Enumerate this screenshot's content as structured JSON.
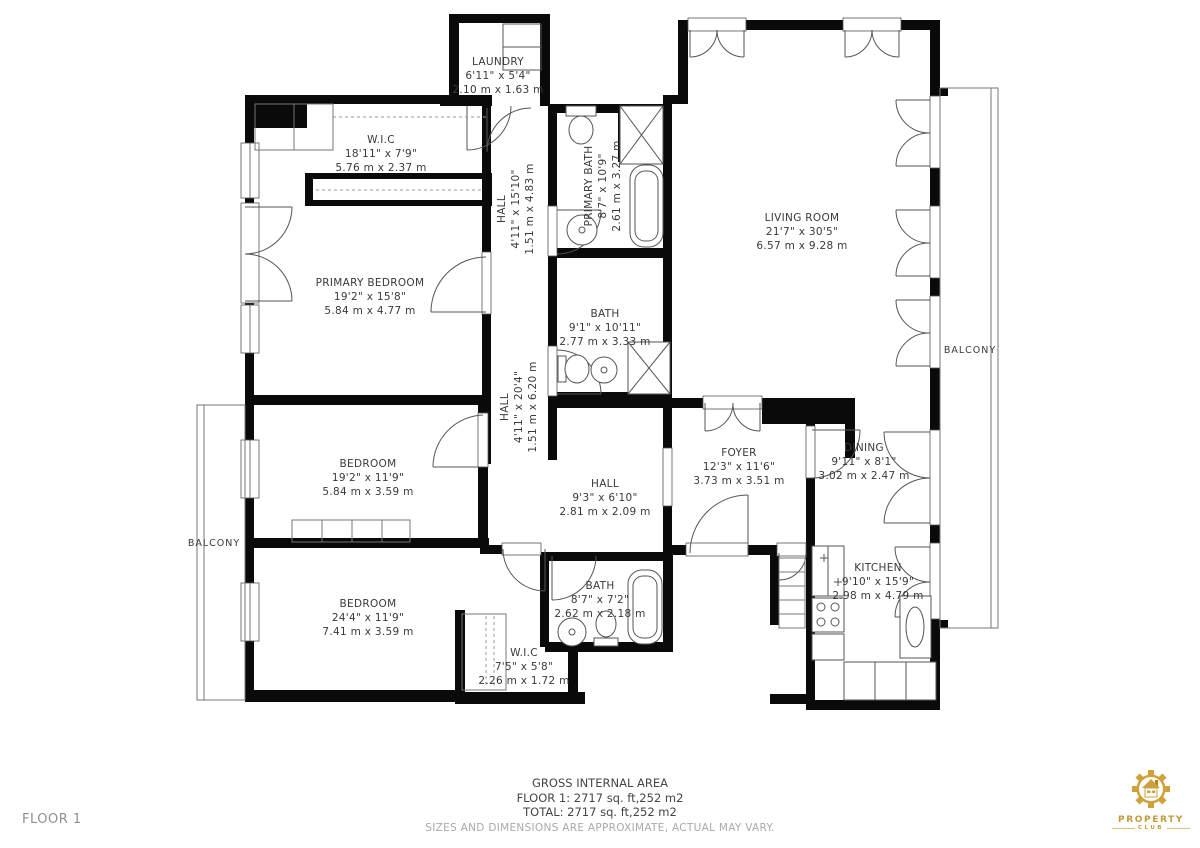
{
  "floor_tag": "FLOOR 1",
  "summary": {
    "title": "GROSS INTERNAL AREA",
    "floor_line": "FLOOR 1: 2717 sq. ft,252 m2",
    "total_line": "TOTAL: 2717 sq. ft,252 m2",
    "disclaimer": "SIZES AND DIMENSIONS ARE APPROXIMATE, ACTUAL MAY VARY."
  },
  "logo": {
    "name": "PROPERTY",
    "sub": "CLUB",
    "gold": "#c49a3c"
  },
  "colors": {
    "wall": "#0a0a0a",
    "line": "#555555",
    "label": "#3a3a3a",
    "muted": "#a9a9a9"
  },
  "rooms": [
    {
      "id": "laundry",
      "name": "LAUNDRY",
      "imperial": "6'11\" x 5'4\"",
      "metric": "2.10 m x 1.63 m"
    },
    {
      "id": "wic-primary",
      "name": "W.I.C",
      "imperial": "18'11\" x 7'9\"",
      "metric": "5.76 m x 2.37 m"
    },
    {
      "id": "hall-upper",
      "name": "HALL",
      "imperial": "4'11\" x 15'10\"",
      "metric": "1.51 m x 4.83 m"
    },
    {
      "id": "primary-bath",
      "name": "PRIMARY BATH",
      "imperial": "8'7\" x 10'9\"",
      "metric": "2.61 m x 3.27 m"
    },
    {
      "id": "living-room",
      "name": "LIVING ROOM",
      "imperial": "21'7\" x 30'5\"",
      "metric": "6.57 m x 9.28 m"
    },
    {
      "id": "primary-bedroom",
      "name": "PRIMARY BEDROOM",
      "imperial": "19'2\" x 15'8\"",
      "metric": "5.84 m x 4.77 m"
    },
    {
      "id": "bath-center",
      "name": "BATH",
      "imperial": "9'1\" x 10'11\"",
      "metric": "2.77 m x 3.33 m"
    },
    {
      "id": "hall-lower",
      "name": "HALL",
      "imperial": "4'11\" x 20'4\"",
      "metric": "1.51 m x 6.20 m"
    },
    {
      "id": "bedroom-middle",
      "name": "BEDROOM",
      "imperial": "19'2\" x 11'9\"",
      "metric": "5.84 m x 3.59 m"
    },
    {
      "id": "hall-center",
      "name": "HALL",
      "imperial": "9'3\" x 6'10\"",
      "metric": "2.81 m x 2.09 m"
    },
    {
      "id": "foyer",
      "name": "FOYER",
      "imperial": "12'3\" x 11'6\"",
      "metric": "3.73 m x 3.51 m"
    },
    {
      "id": "dining",
      "name": "DINING",
      "imperial": "9'11\" x 8'1\"",
      "metric": "3.02 m x 2.47 m"
    },
    {
      "id": "balcony-right",
      "name": "BALCONY"
    },
    {
      "id": "balcony-left",
      "name": "BALCONY"
    },
    {
      "id": "bedroom-bottom",
      "name": "BEDROOM",
      "imperial": "24'4\" x 11'9\"",
      "metric": "7.41 m x 3.59 m"
    },
    {
      "id": "bath-bottom",
      "name": "BATH",
      "imperial": "8'7\" x 7'2\"",
      "metric": "2.62 m x 2.18 m"
    },
    {
      "id": "wic-bottom",
      "name": "W.I.C",
      "imperial": "7'5\" x 5'8\"",
      "metric": "2.26 m x 1.72 m"
    },
    {
      "id": "kitchen",
      "name": "KITCHEN",
      "imperial": "9'10\" x 15'9\"",
      "metric": "2.98 m x 4.79 m"
    }
  ]
}
